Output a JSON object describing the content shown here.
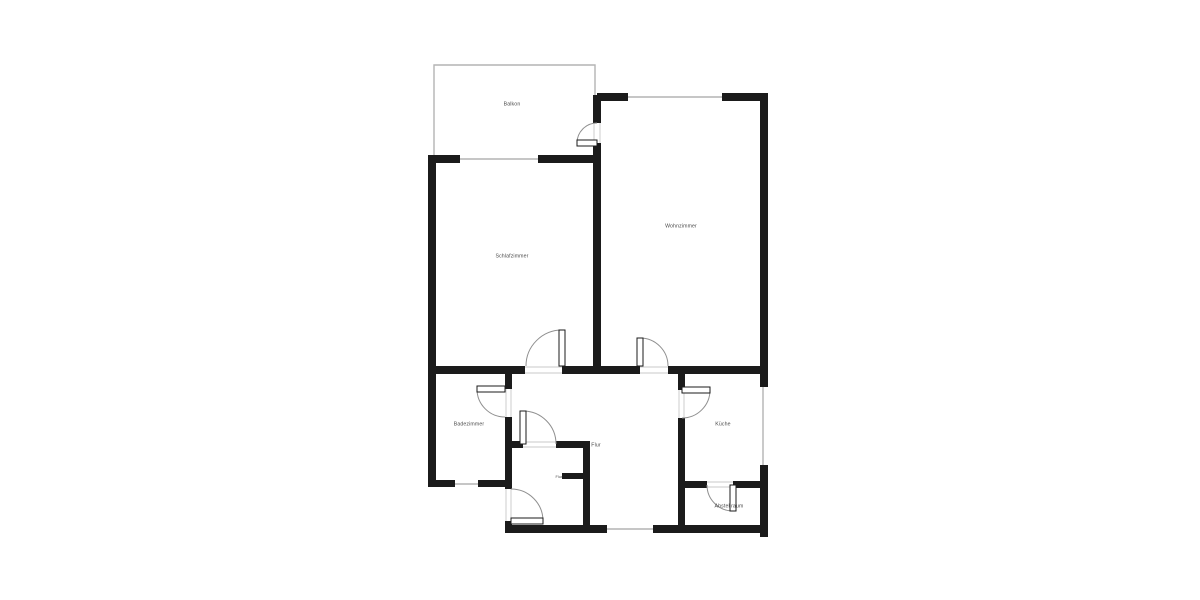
{
  "floorplan": {
    "colors": {
      "wall": "#1b1b1b",
      "window": "#b4b4b4",
      "jamb": "#c9c9c9",
      "arc": "#8f8f8f",
      "label": "#4a4a4a",
      "background": "#ffffff"
    },
    "rooms": {
      "balkon": {
        "label": "Balkon"
      },
      "schlafzimmer": {
        "label": "Schlafzimmer"
      },
      "wohnzimmer": {
        "label": "Wohnzimmer"
      },
      "badezimmer": {
        "label": "Badezimmer"
      },
      "flur": {
        "label": "Flur"
      },
      "flur_klein": {
        "label": "Flur"
      },
      "kueche": {
        "label": "Küche"
      },
      "abstellraum": {
        "label": "Abstellraum"
      }
    }
  }
}
